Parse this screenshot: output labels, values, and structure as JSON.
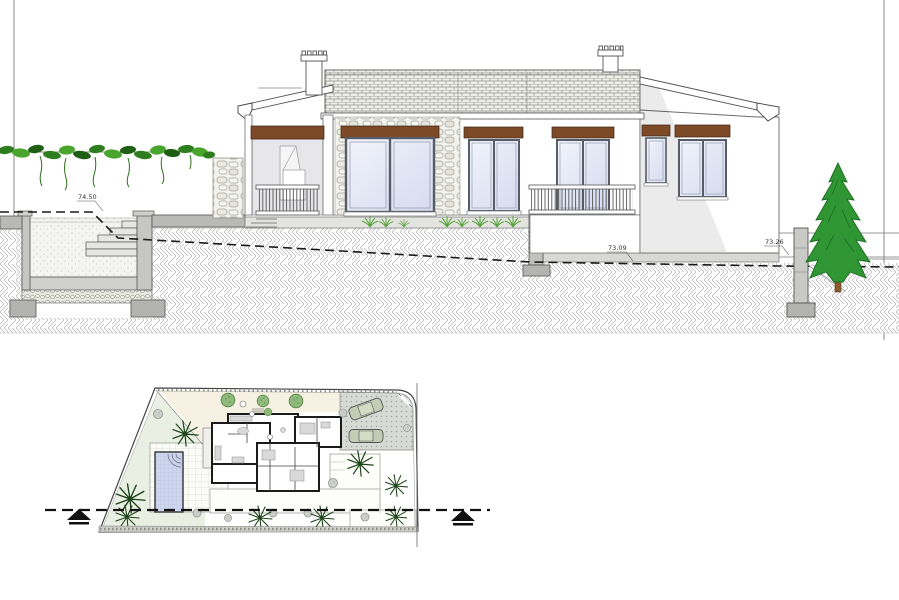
{
  "document": {
    "title": "Villa section elevation and site plan",
    "view_types": [
      "section-elevation",
      "site-plan"
    ],
    "background": "#ffffff"
  },
  "elevation": {
    "levels": [
      {
        "id": "pool-terrace-level",
        "label": "74.50"
      },
      {
        "id": "lower-terrace-level",
        "label": "73.09"
      },
      {
        "id": "garden-level",
        "label": "73.26"
      }
    ],
    "features": [
      "vine-pergola",
      "swimming-pool-section",
      "porch-with-railing",
      "stone-clad-facade",
      "tiled-roof",
      "two-chimneys",
      "sliding-glass-doors",
      "timber-lintels",
      "conifer-tree",
      "fence-post",
      "ground-hatch"
    ]
  },
  "site_plan": {
    "features": [
      "trapezoid-plot-boundary",
      "house-floor-plan",
      "swimming-pool",
      "pool-deck",
      "parking-area",
      "two-cars",
      "palm-trees",
      "round-shrubs",
      "terraces",
      "section-cut-line"
    ],
    "section_marker": {
      "line_style": "dashed",
      "arrow_count": 2
    }
  },
  "colors": {
    "lintel_brown": "#7d4a28",
    "glass_blue": "#dfe4f4",
    "vine_green": "#2e7d1e",
    "tree_green": "#2f9633",
    "plan_pool_blue": "#cdd6ec",
    "hatch_grey": "#b5b5b5",
    "slab_grey": "#b9b9b9",
    "cream_zone": "#f6f1e2",
    "green_zone": "#e9efe2"
  }
}
